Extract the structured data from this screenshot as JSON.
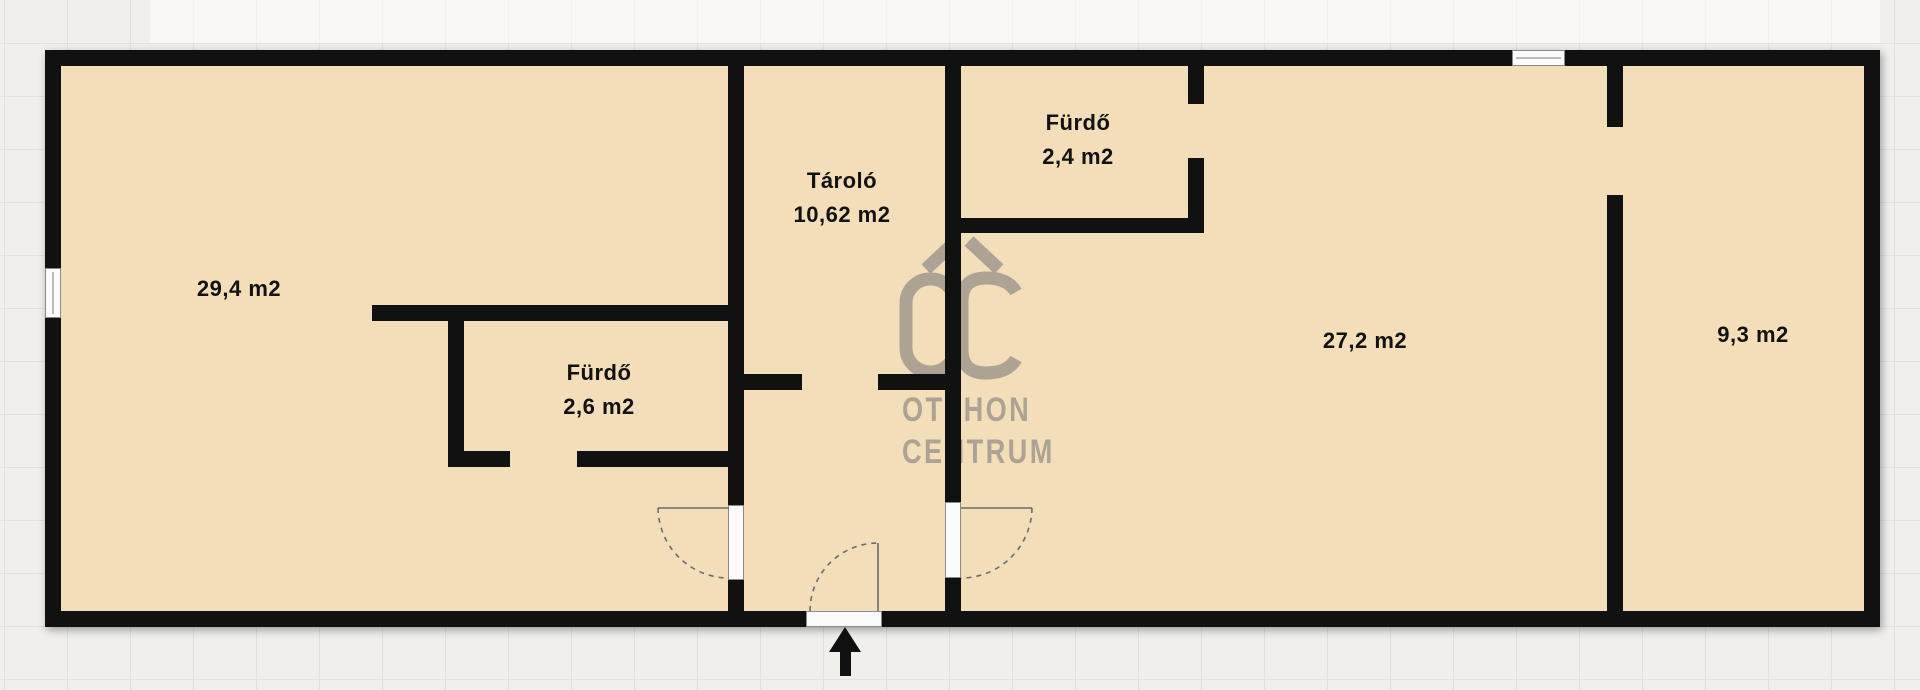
{
  "document": {
    "type": "floor-plan",
    "language": "hu"
  },
  "rooms": [
    {
      "id": "room-left",
      "label": "",
      "area": "29,4 m2"
    },
    {
      "id": "bathroom-left",
      "label": "Fürdő",
      "area": "2,6 m2"
    },
    {
      "id": "storage",
      "label": "Tároló",
      "area": "10,62 m2"
    },
    {
      "id": "bathroom-right",
      "label": "Fürdő",
      "area": "2,4 m2"
    },
    {
      "id": "room-center-right",
      "label": "",
      "area": "27,2 m2"
    },
    {
      "id": "room-far-right",
      "label": "",
      "area": "9,3 m2"
    }
  ],
  "watermark": {
    "logo": "OC",
    "line1": "OTTHON",
    "line2": "CENTRUM"
  },
  "colors": {
    "wall": "#111111",
    "floor": "#f2deb8",
    "background": "#f1efec",
    "grid_line": "#e3e1de",
    "watermark": "#a9a093",
    "door_frame": "#8a8a8a",
    "arrow": "#111111"
  }
}
